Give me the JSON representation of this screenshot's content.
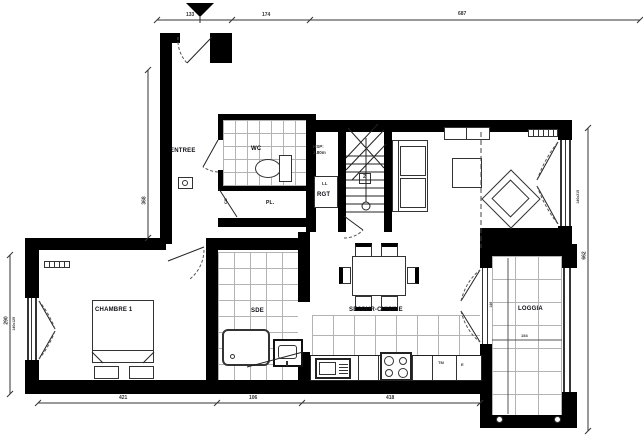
{
  "plan": {
    "title": "apartment-floor-plan",
    "rooms": {
      "entree": "ENTREE",
      "wc": "WC",
      "placard": "PL.",
      "rangement": "RGT",
      "chambre1": "CHAMBRE 1",
      "sde": "SDE",
      "sejour_cuisine": "SEJOUR-CUISINE",
      "loggia": "LOGGIA"
    },
    "annotations": {
      "ceiling_height_label": "HSP:",
      "ceiling_height_value": "1.80m",
      "washing_machine": "LL",
      "water_heater": "CE",
      "kitchen_tm": "TM",
      "kitchen_e": "E",
      "stair_number": "2"
    },
    "dimensions": {
      "top_left": "133",
      "top_mid": "174",
      "top_right": "687",
      "bottom_chambre": "421",
      "bottom_sde": "106",
      "bottom_cuisine": "418",
      "left_chambre": "290",
      "left_entree": "368",
      "right_total": "662",
      "loggia_width": "154",
      "loggia_side": "146",
      "window_left": "140x125",
      "window_right": "140x215"
    },
    "colors": {
      "wall": "#000000",
      "tile_line": "#b3b3b3",
      "dim_line": "#333333"
    }
  }
}
